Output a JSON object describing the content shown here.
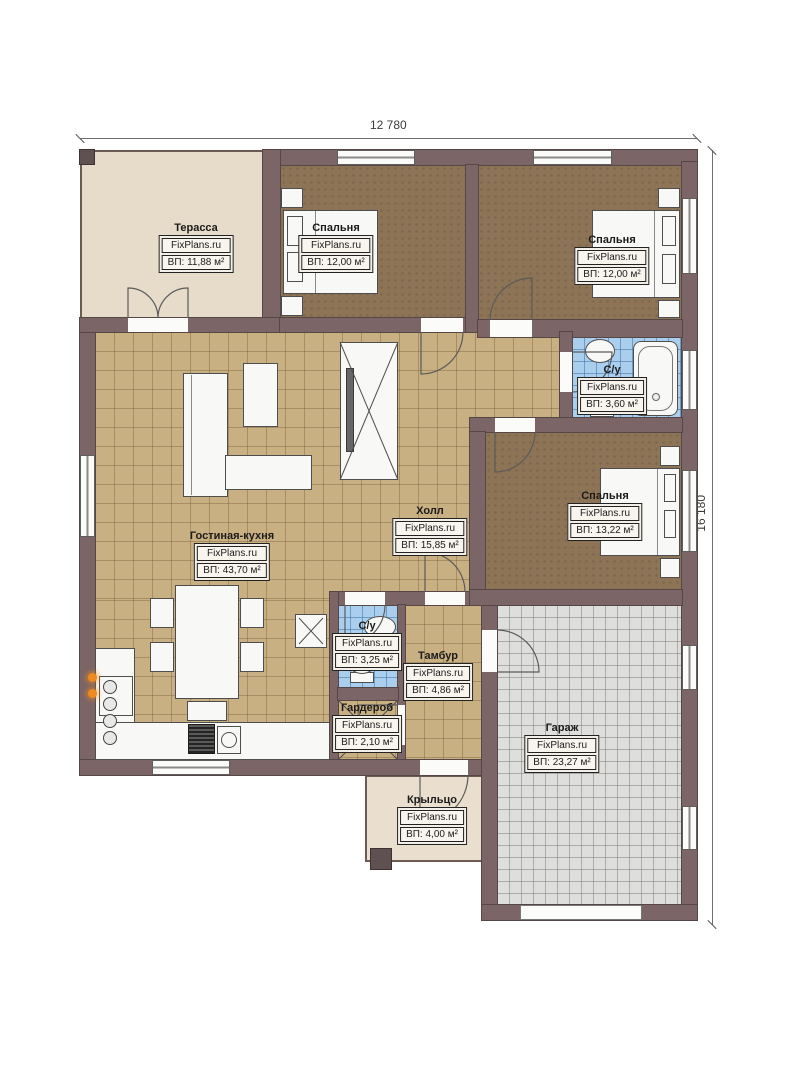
{
  "meta": {
    "brand": "FixPlans.ru",
    "type": "floor-plan"
  },
  "dimensions": {
    "width_label": "12 780",
    "height_label": "16 180"
  },
  "rooms": [
    {
      "id": "terrace",
      "name": "Терасса",
      "area": "ВП: 11,88 м²"
    },
    {
      "id": "bedroom1",
      "name": "Спальня",
      "area": "ВП: 12,00 м²"
    },
    {
      "id": "bedroom2",
      "name": "Спальня",
      "area": "ВП: 12,00 м²"
    },
    {
      "id": "bath1",
      "name": "С/у",
      "area": "ВП: 3,60 м²"
    },
    {
      "id": "bedroom3",
      "name": "Спальня",
      "area": "ВП: 13,22 м²"
    },
    {
      "id": "hall",
      "name": "Холл",
      "area": "ВП: 15,85 м²"
    },
    {
      "id": "living",
      "name": "Гостиная-кухня",
      "area": "ВП: 43,70 м²"
    },
    {
      "id": "bath2",
      "name": "С/у",
      "area": "ВП: 3,25 м²"
    },
    {
      "id": "tambur",
      "name": "Тамбур",
      "area": "ВП: 4,86 м²"
    },
    {
      "id": "wardrobe",
      "name": "Гардероб",
      "area": "ВП: 2,10 м²"
    },
    {
      "id": "garage",
      "name": "Гараж",
      "area": "ВП: 23,27 м²"
    },
    {
      "id": "porch",
      "name": "Крыльцо",
      "area": "ВП: 4,00 м²"
    }
  ],
  "colors": {
    "wall": "#7b6566",
    "bedroom_floor": "#8d7457",
    "living_floor": "#c9b083",
    "bath_floor": "#aacfee",
    "garage_floor": "#dededc",
    "terrace_floor": "#e6dcc9",
    "porch_floor": "#eadfce",
    "flame_accent": "#ef8a1f"
  }
}
